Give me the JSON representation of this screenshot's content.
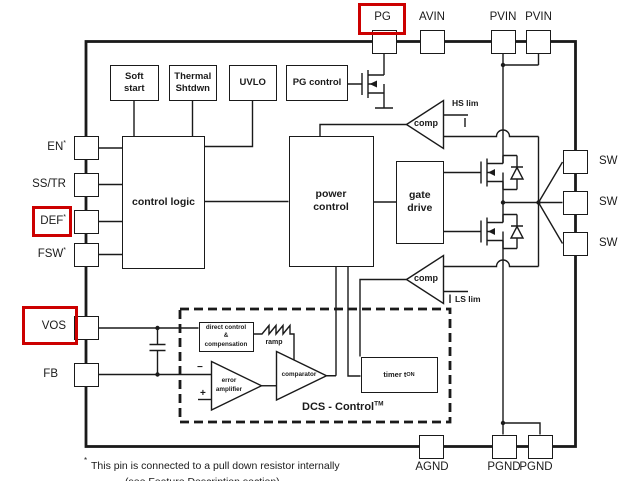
{
  "pins": {
    "top": [
      {
        "label": "PG",
        "highlighted": true
      },
      {
        "label": "AVIN"
      },
      {
        "label": "PVIN"
      },
      {
        "label": "PVIN"
      }
    ],
    "left": [
      {
        "label": "EN",
        "sup": "*"
      },
      {
        "label": "SS/TR",
        "sup": ""
      },
      {
        "label": "DEF",
        "sup": "*",
        "highlighted": true
      },
      {
        "label": "FSW",
        "sup": "*"
      },
      {
        "label": "VOS",
        "sup": "",
        "highlighted": true
      },
      {
        "label": "FB",
        "sup": ""
      }
    ],
    "right": [
      {
        "label": "SW"
      },
      {
        "label": "SW"
      },
      {
        "label": "SW"
      }
    ],
    "bottom": [
      {
        "label": "AGND"
      },
      {
        "label": "PGND"
      },
      {
        "label": "PGND"
      }
    ]
  },
  "blocks": {
    "soft_start": "Soft\nstart",
    "thermal_shutdown": "Thermal\nShtdwn",
    "uvlo": "UVLO",
    "pg_control": "PG control",
    "control_logic": "control logic",
    "power_control": "power\ncontrol",
    "gate_drive": "gate\ndrive",
    "direct_control": "direct control\n&\ncompensation",
    "timer": {
      "label": "timer t",
      "sub": "ON"
    },
    "error_amplifier": "error\namplifier",
    "comparator": "comparator",
    "hs_comp": "comp",
    "ls_comp": "comp",
    "hs_limit": "HS lim",
    "ls_limit": "LS lim",
    "ramp": "ramp",
    "dcs": {
      "label": "DCS - Control",
      "sup": "TM"
    }
  },
  "symbols": {
    "minus": "−",
    "plus": "+"
  },
  "footnote": {
    "sup": "*",
    "line1": "This pin is connected to a pull down resistor internally",
    "line2": "(see Feature Description section)"
  },
  "colors": {
    "line": "#1a1a1a",
    "highlight": "#cc0000",
    "background": "#ffffff"
  }
}
